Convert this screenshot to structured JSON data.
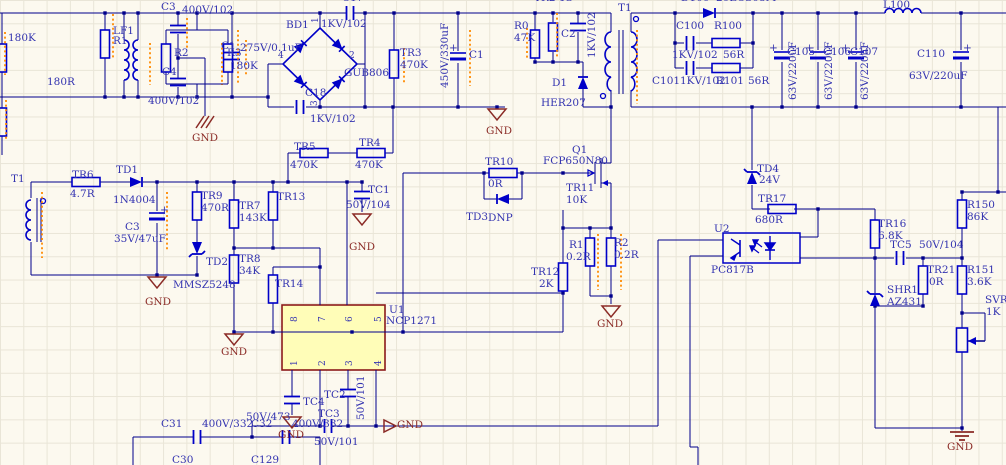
{
  "canvas": {
    "width": 1006,
    "height": 465,
    "background": "#FCF9EF",
    "grid_color": "#E9E5D7",
    "wire_color": "#00008B",
    "component_color": "#0000C8",
    "text_blue": "#3434B0",
    "text_maroon": "#8B2B26",
    "ic_fill": "#FFFDB8",
    "ic_border": "#8B1A1A",
    "erc_mark_color": "#FF8A00"
  },
  "ic_u1": {
    "refdes": "U1",
    "part": "NCP1271",
    "pins_top": [
      "8",
      "7",
      "6",
      "5"
    ],
    "pins_bottom": [
      "1",
      "2",
      "3",
      "4"
    ]
  },
  "optocoupler": {
    "refdes": "U2",
    "part": "PC817B"
  },
  "labels": [
    {
      "n": "val-input-res",
      "t": "180K",
      "x": 8,
      "y": 33
    },
    {
      "n": "ref-r1",
      "t": "R1",
      "x": 113,
      "y": 36
    },
    {
      "n": "ref-r2",
      "t": "R2",
      "x": 174,
      "y": 48
    },
    {
      "n": "ref-r3",
      "t": "R3",
      "x": 227,
      "y": 48
    },
    {
      "n": "val-r3",
      "t": "180K",
      "x": 230,
      "y": 61
    },
    {
      "n": "val-r2",
      "t": "180R",
      "x": 47,
      "y": 77
    },
    {
      "n": "ref-lf1",
      "t": "LF1",
      "x": 113,
      "y": 26
    },
    {
      "n": "ref-c3a",
      "t": "C3",
      "x": 161,
      "y": 2
    },
    {
      "n": "val-c3a",
      "t": "400V/102",
      "x": 182,
      "y": 5
    },
    {
      "n": "ref-c4",
      "t": "C4",
      "x": 162,
      "y": 67
    },
    {
      "n": "val-c4",
      "t": "400V/102",
      "x": 148,
      "y": 96
    },
    {
      "n": "net-gnd-1",
      "t": "GND",
      "x": 192,
      "y": 133,
      "c": "m"
    },
    {
      "n": "ref-c1-in",
      "t": "C1",
      "x": 221,
      "y": 41
    },
    {
      "n": "val-c1-in",
      "t": "275V/0.1uF",
      "x": 240,
      "y": 43
    },
    {
      "n": "ref-bd1",
      "t": "BD1",
      "x": 286,
      "y": 20
    },
    {
      "n": "ref-c17-clipped",
      "t": "C17",
      "x": 342,
      "y": -7
    },
    {
      "n": "val-c17",
      "t": "1KV/102",
      "x": 321,
      "y": 19
    },
    {
      "n": "part-bd1",
      "t": "GUB806",
      "x": 344,
      "y": 68
    },
    {
      "n": "pin-bd1-1",
      "t": "1",
      "x": 311,
      "y": 23,
      "r": 1,
      "s": 9
    },
    {
      "n": "pin-bd1-2",
      "t": "2",
      "x": 349,
      "y": 51,
      "s": 9
    },
    {
      "n": "pin-bd1-3",
      "t": "3",
      "x": 310,
      "y": 106,
      "r": 1,
      "s": 9
    },
    {
      "n": "pin-bd1-4",
      "t": "4",
      "x": 278,
      "y": 51,
      "s": 9
    },
    {
      "n": "ref-c18",
      "t": "C18",
      "x": 305,
      "y": 88
    },
    {
      "n": "val-c18",
      "t": "1KV/102",
      "x": 310,
      "y": 114
    },
    {
      "n": "ref-tr3",
      "t": "TR3",
      "x": 400,
      "y": 48
    },
    {
      "n": "val-tr3",
      "t": "470K",
      "x": 400,
      "y": 60
    },
    {
      "n": "val-c1-bulk",
      "t": "450V/330uF",
      "x": 440,
      "y": 88,
      "r": 1
    },
    {
      "n": "ref-c1-bulk",
      "t": "C1",
      "x": 469,
      "y": 50
    },
    {
      "n": "plus-c1-bulk",
      "t": "+",
      "x": 449,
      "y": 43
    },
    {
      "n": "net-gnd-2",
      "t": "GND",
      "x": 486,
      "y": 126,
      "c": "m"
    },
    {
      "n": "ref-r0",
      "t": "R0",
      "x": 514,
      "y": 21
    },
    {
      "n": "val-r0",
      "t": "47K",
      "x": 514,
      "y": 33
    },
    {
      "n": "ref-tr2-clipped",
      "t": "TR2 1S",
      "x": 534,
      "y": -7
    },
    {
      "n": "ref-c2",
      "t": "C2",
      "x": 561,
      "y": 29
    },
    {
      "n": "val-c2",
      "t": "1KV/102",
      "x": 587,
      "y": 58,
      "r": 1
    },
    {
      "n": "ref-d1",
      "t": "D1",
      "x": 552,
      "y": 78
    },
    {
      "n": "part-d1",
      "t": "HER207",
      "x": 541,
      "y": 98
    },
    {
      "n": "ref-t1-main",
      "t": "T1",
      "x": 618,
      "y": 3
    },
    {
      "n": "ref-d100-clipped",
      "t": "D100",
      "x": 681,
      "y": -7
    },
    {
      "n": "part-d100-clipped",
      "t": "20ECS08M",
      "x": 716,
      "y": -7
    },
    {
      "n": "ref-c100",
      "t": "C100",
      "x": 676,
      "y": 21
    },
    {
      "n": "ref-r100",
      "t": "R100",
      "x": 714,
      "y": 21
    },
    {
      "n": "val-c100",
      "t": "1KV/102",
      "x": 672,
      "y": 50
    },
    {
      "n": "val-r100",
      "t": "56R",
      "x": 723,
      "y": 50
    },
    {
      "n": "ref-c101",
      "t": "C101",
      "x": 652,
      "y": 76
    },
    {
      "n": "val-c101",
      "t": "1KV/102",
      "x": 680,
      "y": 76
    },
    {
      "n": "ref-r101",
      "t": "R101",
      "x": 716,
      "y": 76
    },
    {
      "n": "val-r101",
      "t": "56R",
      "x": 748,
      "y": 76
    },
    {
      "n": "ref-l100",
      "t": "L100",
      "x": 883,
      "y": 0
    },
    {
      "n": "plus-c105",
      "t": "+",
      "x": 769,
      "y": 43
    },
    {
      "n": "ref-c105",
      "t": "C105",
      "x": 787,
      "y": 47
    },
    {
      "n": "val-c105",
      "t": "63V/220uF",
      "x": 788,
      "y": 100,
      "r": 1
    },
    {
      "n": "plus-c106",
      "t": "+",
      "x": 805,
      "y": 43
    },
    {
      "n": "ref-c106",
      "t": "C106",
      "x": 823,
      "y": 47
    },
    {
      "n": "val-c106",
      "t": "63V/220uF",
      "x": 824,
      "y": 100,
      "r": 1
    },
    {
      "n": "plus-c107",
      "t": "+",
      "x": 841,
      "y": 43
    },
    {
      "n": "ref-c107",
      "t": "C107",
      "x": 850,
      "y": 47
    },
    {
      "n": "val-c107",
      "t": "63V/220uF",
      "x": 860,
      "y": 100,
      "r": 1
    },
    {
      "n": "ref-c110",
      "t": "C110",
      "x": 917,
      "y": 49
    },
    {
      "n": "plus-c110",
      "t": "+",
      "x": 963,
      "y": 43
    },
    {
      "n": "val-c110",
      "t": "63V/220uF",
      "x": 909,
      "y": 71
    },
    {
      "n": "ref-q1",
      "t": "Q1",
      "x": 572,
      "y": 145
    },
    {
      "n": "part-q1",
      "t": "FCP650N80",
      "x": 543,
      "y": 156
    },
    {
      "n": "ref-tr11",
      "t": "TR11",
      "x": 566,
      "y": 183
    },
    {
      "n": "val-tr11",
      "t": "10K",
      "x": 566,
      "y": 195
    },
    {
      "n": "ref-tr5",
      "t": "TR5",
      "x": 294,
      "y": 142
    },
    {
      "n": "val-tr5",
      "t": "470K",
      "x": 290,
      "y": 160
    },
    {
      "n": "ref-tr4",
      "t": "TR4",
      "x": 359,
      "y": 138
    },
    {
      "n": "val-tr4",
      "t": "470K",
      "x": 355,
      "y": 160
    },
    {
      "n": "ref-tc1",
      "t": "TC1",
      "x": 368,
      "y": 185
    },
    {
      "n": "val-tc1",
      "t": "50V/104",
      "x": 346,
      "y": 200
    },
    {
      "n": "net-gnd-3",
      "t": "GND",
      "x": 349,
      "y": 242,
      "c": "m"
    },
    {
      "n": "ref-tr10",
      "t": "TR10",
      "x": 485,
      "y": 157
    },
    {
      "n": "val-tr10",
      "t": "0R",
      "x": 488,
      "y": 179
    },
    {
      "n": "ref-td3",
      "t": "TD3",
      "x": 466,
      "y": 212
    },
    {
      "n": "val-td3",
      "t": "DNP",
      "x": 488,
      "y": 213
    },
    {
      "n": "ref-tr6",
      "t": "TR6",
      "x": 72,
      "y": 170
    },
    {
      "n": "val-tr6",
      "t": "4.7R",
      "x": 70,
      "y": 189
    },
    {
      "n": "ref-td1",
      "t": "TD1",
      "x": 116,
      "y": 165
    },
    {
      "n": "part-td1",
      "t": "1N4004",
      "x": 113,
      "y": 195
    },
    {
      "n": "ref-t1-aux",
      "t": "T1",
      "x": 11,
      "y": 174
    },
    {
      "n": "plus-c3-aux",
      "t": "+",
      "x": 160,
      "y": 205
    },
    {
      "n": "ref-c3-aux",
      "t": "C3",
      "x": 125,
      "y": 222
    },
    {
      "n": "val-c3-aux",
      "t": "35V/47uF",
      "x": 114,
      "y": 234
    },
    {
      "n": "ref-tr9",
      "t": "TR9",
      "x": 201,
      "y": 191
    },
    {
      "n": "val-tr9",
      "t": "470R",
      "x": 201,
      "y": 203
    },
    {
      "n": "ref-tr7",
      "t": "TR7",
      "x": 239,
      "y": 201
    },
    {
      "n": "val-tr7",
      "t": "143K",
      "x": 239,
      "y": 213
    },
    {
      "n": "ref-td2",
      "t": "TD2",
      "x": 206,
      "y": 257
    },
    {
      "n": "part-td2",
      "t": "MMSZ5248",
      "x": 173,
      "y": 280
    },
    {
      "n": "net-gnd-4",
      "t": "GND",
      "x": 145,
      "y": 297,
      "c": "m"
    },
    {
      "n": "ref-tr8",
      "t": "TR8",
      "x": 239,
      "y": 254
    },
    {
      "n": "val-tr8",
      "t": "34K",
      "x": 239,
      "y": 266
    },
    {
      "n": "net-gnd-5",
      "t": "GND",
      "x": 221,
      "y": 347,
      "c": "m"
    },
    {
      "n": "ref-tr13",
      "t": "TR13",
      "x": 277,
      "y": 192
    },
    {
      "n": "ref-tr14",
      "t": "TR14",
      "x": 275,
      "y": 279
    },
    {
      "n": "ref-u1",
      "t": "U1",
      "x": 389,
      "y": 305
    },
    {
      "n": "part-u1",
      "t": "NCP1271",
      "x": 386,
      "y": 316
    },
    {
      "n": "pin-u1-8",
      "t": "8",
      "x": 290,
      "y": 322,
      "r": 1,
      "s": 9
    },
    {
      "n": "pin-u1-7",
      "t": "7",
      "x": 318,
      "y": 322,
      "r": 1,
      "s": 9
    },
    {
      "n": "pin-u1-6",
      "t": "6",
      "x": 345,
      "y": 322,
      "r": 1,
      "s": 9
    },
    {
      "n": "pin-u1-5",
      "t": "5",
      "x": 374,
      "y": 322,
      "r": 1,
      "s": 9
    },
    {
      "n": "pin-u1-1",
      "t": "1",
      "x": 290,
      "y": 366,
      "r": 1,
      "s": 9
    },
    {
      "n": "pin-u1-2",
      "t": "2",
      "x": 318,
      "y": 366,
      "r": 1,
      "s": 9
    },
    {
      "n": "pin-u1-3",
      "t": "3",
      "x": 345,
      "y": 366,
      "r": 1,
      "s": 9
    },
    {
      "n": "pin-u1-4",
      "t": "4",
      "x": 374,
      "y": 366,
      "r": 1,
      "s": 9
    },
    {
      "n": "ref-tc4",
      "t": "TC4",
      "x": 303,
      "y": 397
    },
    {
      "n": "val-tc4",
      "t": "50V/473",
      "x": 246,
      "y": 412
    },
    {
      "n": "net-gnd-6",
      "t": "GND",
      "x": 278,
      "y": 430,
      "c": "m"
    },
    {
      "n": "ref-tc2",
      "t": "TC2",
      "x": 324,
      "y": 390
    },
    {
      "n": "val-tc2",
      "t": "50V/101",
      "x": 356,
      "y": 420,
      "r": 1
    },
    {
      "n": "ref-tc3",
      "t": "TC3",
      "x": 318,
      "y": 409
    },
    {
      "n": "val-tc3",
      "t": "50V/101",
      "x": 314,
      "y": 437
    },
    {
      "n": "net-gnd-7",
      "t": "GND",
      "x": 397,
      "y": 420,
      "c": "m"
    },
    {
      "n": "ref-r1-sense",
      "t": "R1",
      "x": 569,
      "y": 240
    },
    {
      "n": "val-r1-sense",
      "t": "0.2R",
      "x": 566,
      "y": 252
    },
    {
      "n": "ref-r2-sense",
      "t": "R2",
      "x": 614,
      "y": 238
    },
    {
      "n": "val-r2-sense",
      "t": "0.2R",
      "x": 614,
      "y": 250
    },
    {
      "n": "ref-tr12",
      "t": "TR12",
      "x": 531,
      "y": 267
    },
    {
      "n": "val-tr12",
      "t": "2K",
      "x": 539,
      "y": 279
    },
    {
      "n": "net-gnd-8",
      "t": "GND",
      "x": 597,
      "y": 319,
      "c": "m"
    },
    {
      "n": "ref-td4",
      "t": "TD4",
      "x": 757,
      "y": 164
    },
    {
      "n": "val-td4",
      "t": "24V",
      "x": 759,
      "y": 175
    },
    {
      "n": "ref-tr17",
      "t": "TR17",
      "x": 758,
      "y": 194
    },
    {
      "n": "val-tr17",
      "t": "680R",
      "x": 755,
      "y": 215
    },
    {
      "n": "ref-u2",
      "t": "U2",
      "x": 714,
      "y": 224
    },
    {
      "n": "part-u2",
      "t": "PC817B",
      "x": 711,
      "y": 265
    },
    {
      "n": "ref-tr16",
      "t": "TR16",
      "x": 878,
      "y": 219
    },
    {
      "n": "val-tr16",
      "t": "6.8K",
      "x": 878,
      "y": 231
    },
    {
      "n": "ref-tc5",
      "t": "TC5",
      "x": 890,
      "y": 240
    },
    {
      "n": "val-tc5",
      "t": "50V/104",
      "x": 919,
      "y": 240
    },
    {
      "n": "ref-tr21",
      "t": "TR21",
      "x": 927,
      "y": 265
    },
    {
      "n": "val-tr21",
      "t": "0R",
      "x": 929,
      "y": 277
    },
    {
      "n": "ref-shr1",
      "t": "SHR1",
      "x": 887,
      "y": 285
    },
    {
      "n": "part-shr1",
      "t": "AZ431",
      "x": 887,
      "y": 297
    },
    {
      "n": "ref-r150",
      "t": "R150",
      "x": 967,
      "y": 200
    },
    {
      "n": "val-r150",
      "t": "86K",
      "x": 967,
      "y": 212
    },
    {
      "n": "ref-r151",
      "t": "R151",
      "x": 967,
      "y": 265
    },
    {
      "n": "val-r151",
      "t": "3.6K",
      "x": 967,
      "y": 277
    },
    {
      "n": "ref-svr1-clipped",
      "t": "SVR1",
      "x": 985,
      "y": 295
    },
    {
      "n": "val-svr1",
      "t": "1K",
      "x": 986,
      "y": 307
    },
    {
      "n": "net-gnd-9",
      "t": "GND",
      "x": 947,
      "y": 442,
      "c": "m"
    },
    {
      "n": "ref-c31",
      "t": "C31",
      "x": 161,
      "y": 419
    },
    {
      "n": "val-c31",
      "t": "400V/332",
      "x": 202,
      "y": 419
    },
    {
      "n": "ref-c32",
      "t": "C32",
      "x": 251,
      "y": 419
    },
    {
      "n": "val-c32",
      "t": "400V/332",
      "x": 292,
      "y": 419
    },
    {
      "n": "ref-c30-clipped",
      "t": "C30",
      "x": 172,
      "y": 455
    },
    {
      "n": "ref-c129-clipped",
      "t": "C129",
      "x": 251,
      "y": 455
    }
  ]
}
